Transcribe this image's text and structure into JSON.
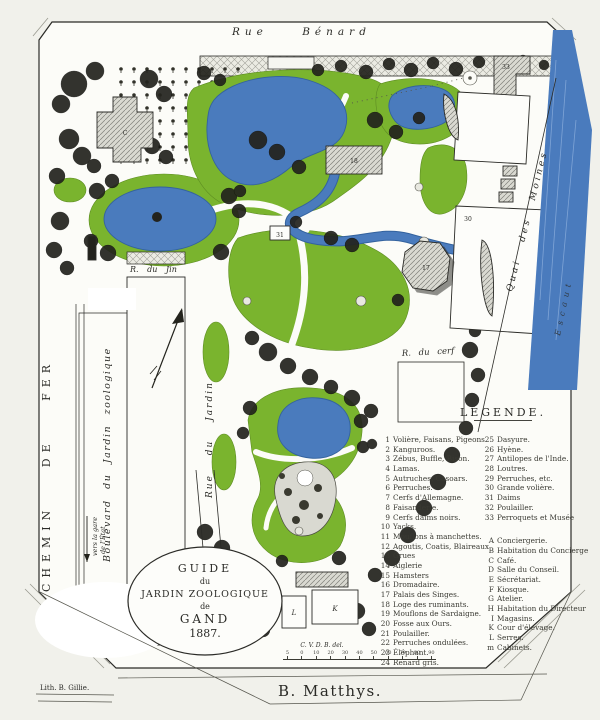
{
  "cartouche": {
    "l1": "GUIDE",
    "l2": "du",
    "l3": "JARDIN ZOOLOGIQUE",
    "l4": "de",
    "l5": "GAND",
    "l6": "1887."
  },
  "streets": {
    "rue_benard": "Rue Bénard",
    "chemin_de_fer": "CHEMIN DE FER",
    "boulevard": "Boulevard du Jardin zoologique",
    "gare_note_1": "vers la gare",
    "gare_note_2": "de l'État",
    "r_du_jin": "R. du Jin",
    "rue_du_jardin": "Rue du Jardin",
    "r_du_cerf": "R. du cerf",
    "quai_des_moines": "Quai des Moines",
    "river": "Escaut"
  },
  "legend": {
    "title": "LÉGENDE.",
    "col1": [
      {
        "num": "1",
        "label": "Volière, Faisans, Pigeons."
      },
      {
        "num": "2",
        "label": "Kanguroos."
      },
      {
        "num": "3",
        "label": "Zébus, Buffle, Bison."
      },
      {
        "num": "4",
        "label": "Lamas."
      },
      {
        "num": "5",
        "label": "Autruches, Casoars."
      },
      {
        "num": "6",
        "label": "Perruches."
      },
      {
        "num": "7",
        "label": "Cerfs d'Allemagne."
      },
      {
        "num": "8",
        "label": "Faisanderie."
      },
      {
        "num": "9",
        "label": "Cerfs daims noirs."
      },
      {
        "num": "10",
        "label": "Yacks."
      },
      {
        "num": "11",
        "label": "Mouflons à manchettes."
      },
      {
        "num": "12",
        "label": "Agoutis, Coatis, Blaireaux"
      },
      {
        "num": "13",
        "label": "Grues"
      },
      {
        "num": "14",
        "label": "Aiglerie"
      },
      {
        "num": "15",
        "label": "Hamsters"
      },
      {
        "num": "16",
        "label": "Dromadaire."
      },
      {
        "num": "17",
        "label": "Palais des Singes."
      },
      {
        "num": "18",
        "label": "Loge des ruminants."
      },
      {
        "num": "19",
        "label": "Mouflons de Sardaigne."
      },
      {
        "num": "20",
        "label": "Fosse aux Ours."
      },
      {
        "num": "21",
        "label": "Poulailler."
      },
      {
        "num": "22",
        "label": "Perruches ondulées."
      },
      {
        "num": "23",
        "label": "Éléphant."
      },
      {
        "num": "24",
        "label": "Renard gris."
      }
    ],
    "col2": [
      {
        "num": "25",
        "label": "Dasyure."
      },
      {
        "num": "26",
        "label": "Hyène."
      },
      {
        "num": "27",
        "label": "Antilopes de l'Inde."
      },
      {
        "num": "28",
        "label": "Loutres."
      },
      {
        "num": "29",
        "label": "Perruches, etc."
      },
      {
        "num": "30",
        "label": "Grande volière."
      },
      {
        "num": "31",
        "label": "Daims"
      },
      {
        "num": "32",
        "label": "Poulailler."
      },
      {
        "num": "33",
        "label": "Perroquets et Musée"
      }
    ],
    "letters": [
      {
        "num": "A",
        "label": "Conciergerie."
      },
      {
        "num": "B",
        "label": "Habitation du Concierge"
      },
      {
        "num": "C",
        "label": "Café."
      },
      {
        "num": "D",
        "label": "Salle du Conseil."
      },
      {
        "num": "E",
        "label": "Sécrétariat."
      },
      {
        "num": "F",
        "label": "Kiosque."
      },
      {
        "num": "G",
        "label": "Atelier."
      },
      {
        "num": "H",
        "label": "Habitation du Directeur"
      },
      {
        "num": "I",
        "label": "Magasins."
      },
      {
        "num": "K",
        "label": "Cour d'élevage."
      },
      {
        "num": "L",
        "label": "Serres."
      },
      {
        "num": "m",
        "label": "Cabinets."
      }
    ]
  },
  "map_labels": {
    "cafe": "C",
    "musee": "33",
    "grande_voliere": "30",
    "ruminants": "18",
    "palais_singes": "17",
    "daims": "31",
    "serres": "L",
    "cour_elevage": "K"
  },
  "scale": {
    "ticks": [
      {
        "t": "5"
      },
      {
        "t": "0"
      },
      {
        "t": "10"
      },
      {
        "t": "20"
      },
      {
        "t": "30"
      },
      {
        "t": "40"
      },
      {
        "t": "50"
      },
      {
        "t": "60"
      },
      {
        "t": "70"
      },
      {
        "t": "80"
      },
      {
        "t": "90"
      }
    ]
  },
  "credits": {
    "lith": "Lith. B. Gillie.",
    "author": "B. Matthys.",
    "delineator": "C. V. D. B. del."
  },
  "colors": {
    "lawn": "#7ab42e",
    "water": "#4a7bbd",
    "tree_dark": "#23231d",
    "paper": "#fcfcf8",
    "ink": "#2b2b27"
  }
}
